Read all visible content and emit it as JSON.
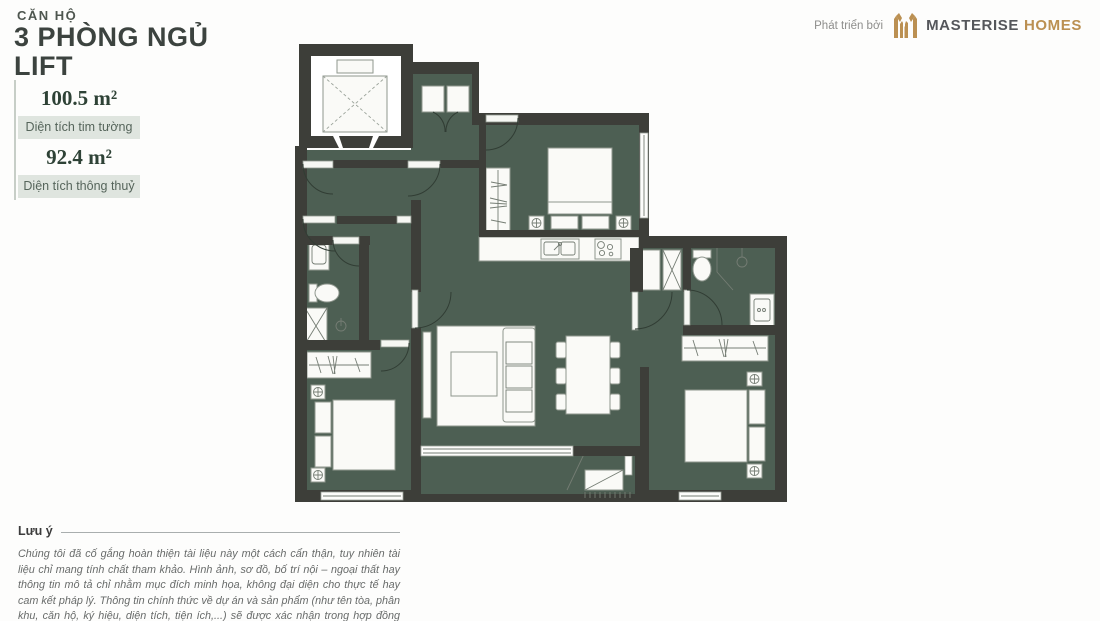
{
  "header": {
    "unit_label": "CĂN HỘ",
    "title_line1": "3 PHÒNG NGỦ",
    "title_line2": "LIFT",
    "areas": [
      {
        "value": "100.5 m²",
        "label": "Diện tích tim tường"
      },
      {
        "value": "92.4 m²",
        "label": "Diện tích thông thuỷ"
      }
    ]
  },
  "branding": {
    "prefix": "Phát triển bởi",
    "logo_icon": "masterise-monogram-icon",
    "brand_primary": "MASTERISE",
    "brand_secondary": "HOMES"
  },
  "note": {
    "label": "Lưu ý",
    "text": "Chúng tôi đã cố gắng hoàn thiện tài liệu này một cách cẩn thận, tuy nhiên tài liệu chỉ mang tính chất tham khảo. Hình ảnh, sơ đồ, bố trí nội – ngoại thất hay thông tin mô tả chỉ nhằm mục đích minh họa, không đại diện cho thực tế hay cam kết pháp lý. Thông tin chính thức về dự án và sản phẩm (như tên tòa, phân khu, căn hộ, ký hiệu, diện tích, tiện ích,...) sẽ được xác nhận trong hợp đồng mua bán và các tài liệu ký với khách hàng."
  },
  "theme": {
    "floor_green": "#4d5f53",
    "wall_dark": "#3d3e39",
    "brand_gold": "#bb9052",
    "brand_gray": "#55575b",
    "badge_bg": "#dfe5df",
    "badge_text": "#56655b",
    "value_color": "#2e4236",
    "title_color": "#3c433f",
    "note_color": "#686b6a"
  }
}
